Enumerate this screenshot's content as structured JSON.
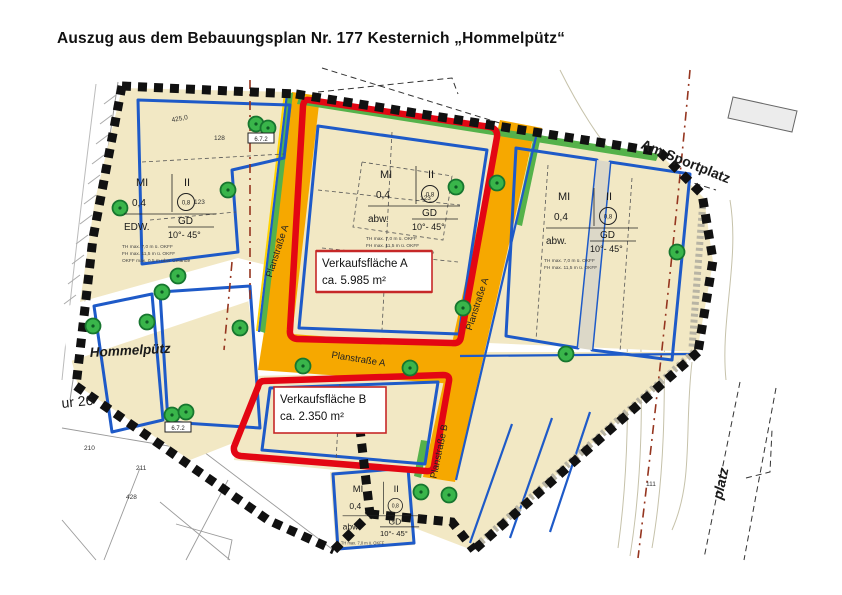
{
  "title": "Auszug aus dem Bebauungsplan Nr. 177 Kesternich „Hommelpütz“",
  "map": {
    "sale_area_a": {
      "name": "Verkaufsfläche A",
      "size": "ca. 5.985 m²"
    },
    "sale_area_b": {
      "name": "Verkaufsfläche B",
      "size": "ca. 2.350 m²"
    },
    "streets": {
      "am_sportplatz": "Am Sportplatz",
      "plan_a": "Planstraße A",
      "plan_b": "Planstraße B",
      "platz": "platz",
      "hommelpuetz": "Hommelpütz"
    },
    "zoning": {
      "use": "MI",
      "storeys": "II",
      "grz": "0,4",
      "circle_value": "0,8",
      "gd": "GD",
      "roof_pitch": "10°- 45°",
      "abw": "abw.",
      "edw": "EDW.",
      "note1": "TH max. 7,0 m ü. OKFF",
      "note2": "FH max. 11,5 m ü. OKFF",
      "note3": "OKFF max. 0,5 m über Gelände"
    },
    "parcel_labels": {
      "flur": "ur 26",
      "tree_box": "6.7.2",
      "n123": "123",
      "n128": "128",
      "n210": "210",
      "n211": "211",
      "n428": "428",
      "n425": "425,0",
      "n111": "111"
    },
    "colors": {
      "parcel": "#F2E8C4",
      "street": "#F6A800",
      "street_edge": "#FFD400",
      "green": "#55B24A",
      "blue": "#1E5AC8",
      "red": "#E30613",
      "boundary": "#111111",
      "brown_dash": "#95351F"
    }
  }
}
